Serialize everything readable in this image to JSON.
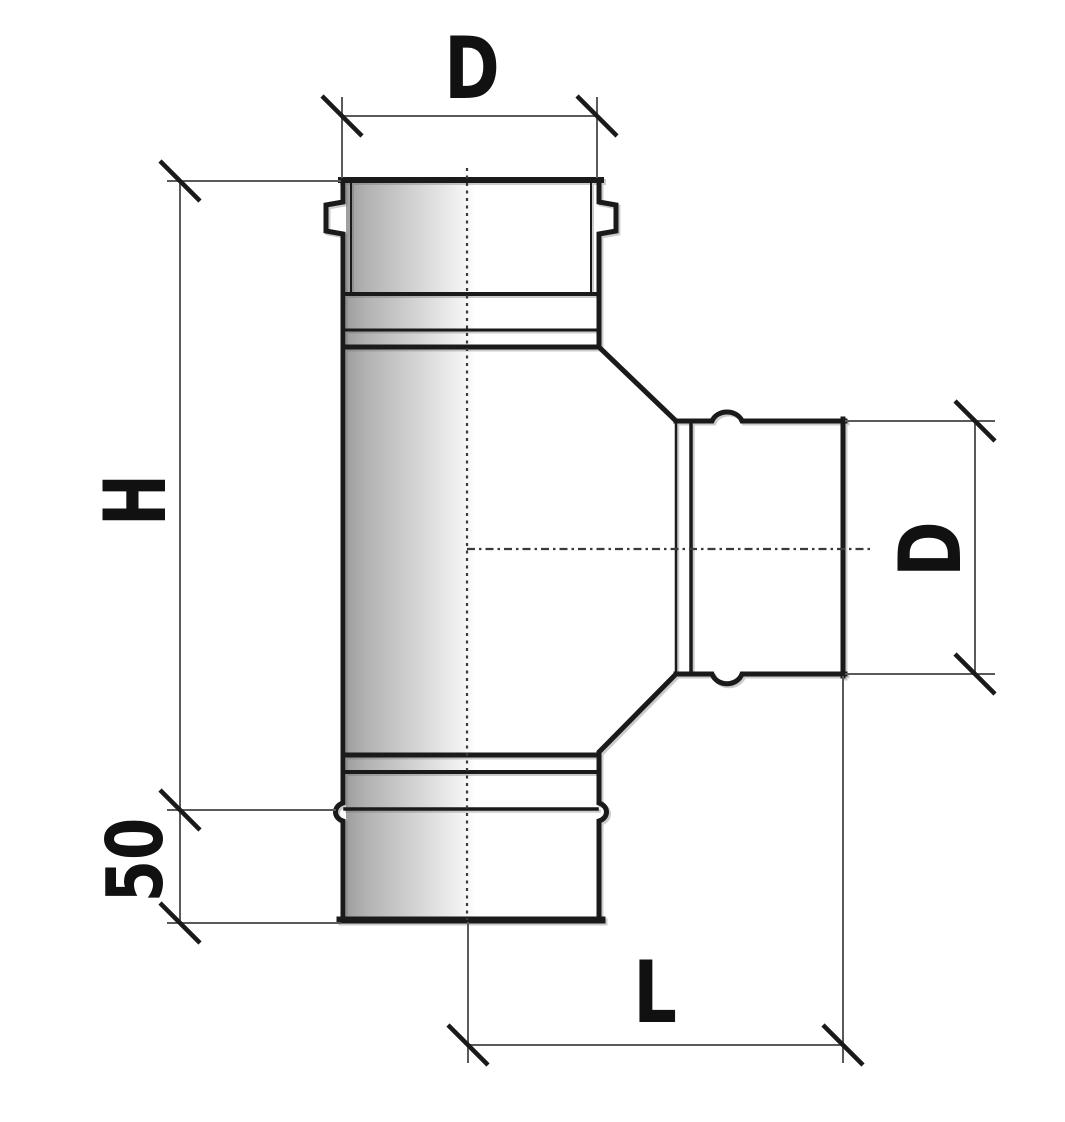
{
  "diagram": {
    "type": "technical-drawing",
    "subject": "pipe-tee-fitting",
    "dimensions": {
      "top_diameter": "D",
      "body_height": "H",
      "branch_diameter": "D",
      "socket_depth": "50",
      "branch_length": "L"
    },
    "colors": {
      "background": "#ffffff",
      "outline": "#1a1a1a",
      "dimension_line": "#5a5a5a",
      "tick": "#1a1a1a",
      "centerline": "#3a3a3a",
      "body_shade_dark": "#9e9e9e",
      "body_shade_light": "#ffffff",
      "label_text": "#111111"
    }
  }
}
